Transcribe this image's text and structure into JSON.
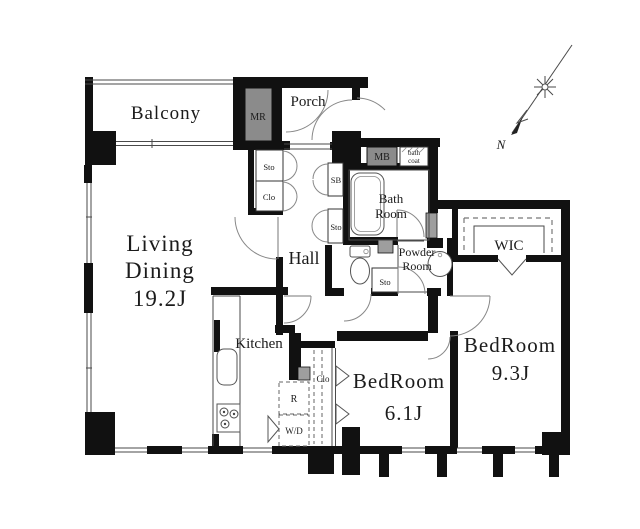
{
  "floorplan": {
    "rooms": {
      "balcony": {
        "label": "Balcony"
      },
      "porch": {
        "label": "Porch"
      },
      "meter_room": {
        "label": "MR"
      },
      "living_dining": {
        "line1": "Living",
        "line2": "Dining",
        "size": "19.2J"
      },
      "kitchen": {
        "label": "Kitchen"
      },
      "hall": {
        "label": "Hall"
      },
      "bath": {
        "line1": "Bath",
        "line2": "Room"
      },
      "powder": {
        "line1": "Powder",
        "line2": "Room"
      },
      "wic": {
        "label": "WIC"
      },
      "bedroom_small": {
        "label": "BedRoom",
        "size": "6.1J"
      },
      "bedroom_large": {
        "label": "BedRoom",
        "size": "9.3J"
      }
    },
    "storage": {
      "sto_entry": "Sto",
      "clo_entry": "Clo",
      "shoe_box": "SB",
      "sto_hall": "Sto",
      "sto_toilet": "Sto",
      "clo_bedroom": "Clo",
      "meter_box": "MB",
      "bath_coat_line1": "bath",
      "bath_coat_line2": "coat",
      "refrigerator": "R",
      "washer_dryer": "W/D"
    },
    "compass": {
      "north_label": "N"
    },
    "colors": {
      "wall": "#111111",
      "meter_box_fill": "#8b8b8b",
      "shaft_fill": "#9e9e9e",
      "background": "#ffffff",
      "thin_line": "#555555"
    }
  }
}
